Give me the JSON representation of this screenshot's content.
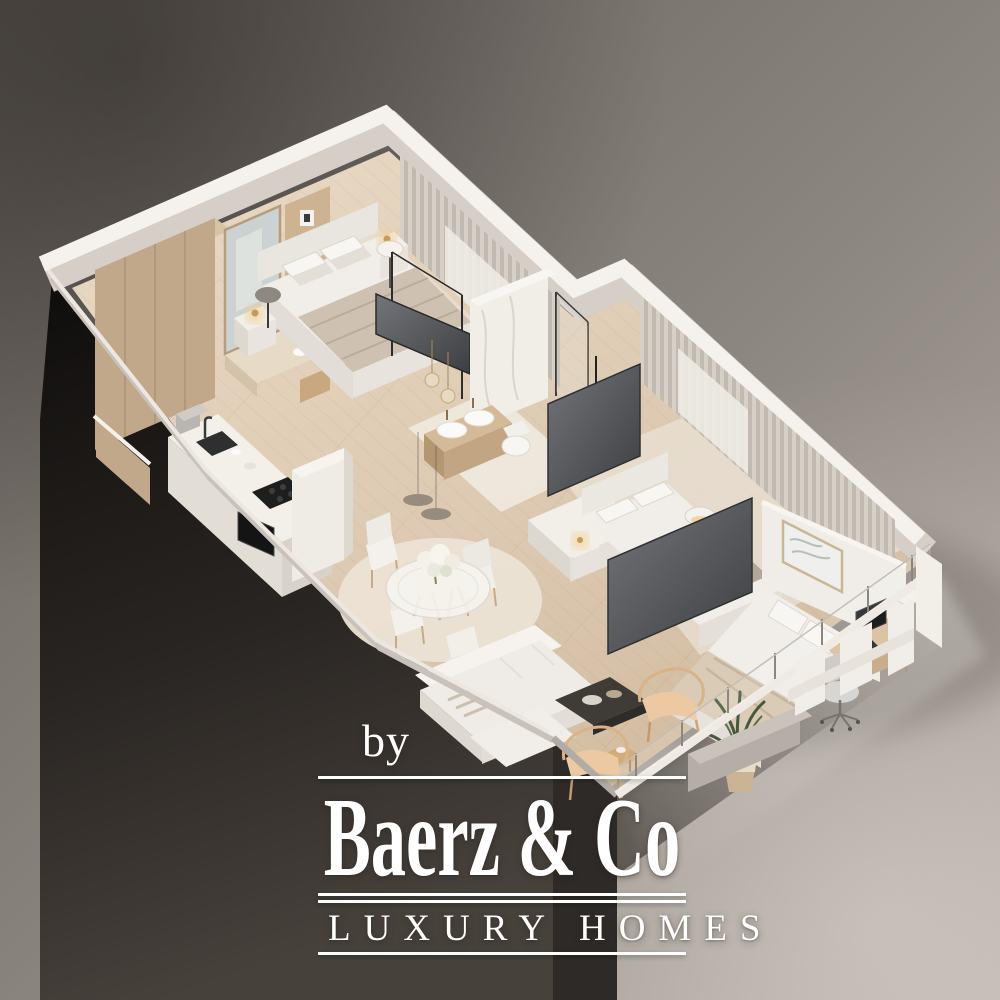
{
  "watermark": {
    "prefix": "by",
    "brand": "Baerz & Co",
    "tagline": "LUXURY HOMES",
    "text_color": "#ffffff"
  },
  "scene": {
    "kind": "isometric 3D cutaway floor-plan rendering of an apartment",
    "rooms": [
      {
        "name": "dressing-area",
        "furnishings": [
          "wood wardrobes",
          "mirror",
          "shelf column",
          "dressing counter"
        ]
      },
      {
        "name": "bedroom-1",
        "furnishings": [
          "double bed",
          "two nightstands",
          "glowing table lamps",
          "tv on glass partition",
          "floor-to-ceiling curtains"
        ]
      },
      {
        "name": "bathroom",
        "furnishings": [
          "double-sink wood vanity",
          "wall-hung toilet",
          "marble shower wall",
          "glass shower door",
          "pendant lights"
        ]
      },
      {
        "name": "kitchen",
        "furnishings": [
          "island with sink and faucet",
          "coffee machine",
          "cooktop",
          "built-in oven",
          "tall cabinet column",
          "wall cabinets"
        ]
      },
      {
        "name": "dining-area",
        "furnishings": [
          "round glass table",
          "four white chairs",
          "round shaggy rug",
          "flower centerpiece",
          "glass pendant lamps"
        ]
      },
      {
        "name": "bedroom-2",
        "furnishings": [
          "double bed with striped throw",
          "nightstand",
          "floor lamp",
          "white sideboard",
          "tv panel"
        ]
      },
      {
        "name": "bedroom-3",
        "furnishings": [
          "double bed",
          "framed artwork",
          "nightstand",
          "desk with monitor",
          "office chair",
          "floor lamp"
        ]
      },
      {
        "name": "living-room",
        "furnishings": [
          "white sofa",
          "dark coffee table",
          "two rattan armchairs",
          "side table",
          "potted plant"
        ]
      },
      {
        "name": "balcony",
        "furnishings": [
          "glass railing with posts",
          "parapet block"
        ]
      }
    ],
    "palette": {
      "background_mid": "#8d8781",
      "background_dark": "#55504b",
      "background_light": "#b6afa8",
      "wall_white": "#f5f2ee",
      "wall_shadow": "#d5cfc8",
      "floor_wood": "#ddc9b1",
      "cabinet_wood": "#c2a88a",
      "shadow_wedge": "#14110f",
      "tv_gray": "#55575a",
      "curtain": "#cfc8bf",
      "lamp_glow": "#f0cc8a",
      "plant_green": "#47583c",
      "rattan": "#e5c09a"
    }
  }
}
